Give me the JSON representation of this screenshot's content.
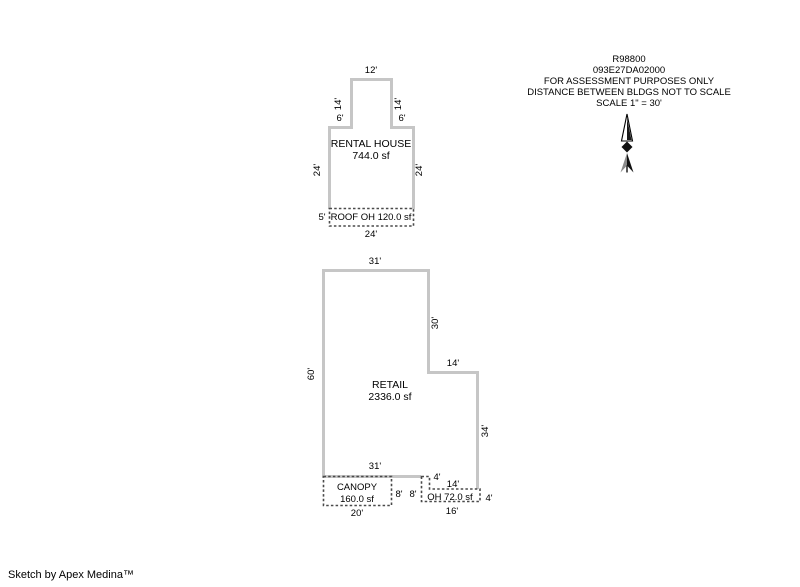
{
  "colors": {
    "background": "#ffffff",
    "building_outline": "#c6c6c6",
    "overhang_dashed": "#4a4a4a",
    "text": "#000000"
  },
  "title_block": {
    "lines": [
      "R98800",
      "093E27DA02000",
      "FOR ASSESSMENT PURPOSES ONLY",
      "DISTANCE BETWEEN BLDGS NOT TO SCALE",
      "SCALE 1\" = 30'"
    ]
  },
  "north_arrow": {
    "icon": "north-arrow"
  },
  "rental_house": {
    "name": "RENTAL HOUSE",
    "area": "744.0 sf",
    "dims": {
      "top_width": "12'",
      "tower_left": "14'",
      "tower_right": "14'",
      "shoulder_left": "6'",
      "shoulder_right": "6'",
      "side_left": "24'",
      "side_right": "24'",
      "roof_oh_height": "5'",
      "bottom_width": "24'"
    },
    "roof_oh": {
      "label": "ROOF OH 120.0 sf"
    }
  },
  "retail": {
    "name": "RETAIL",
    "area": "2336.0 sf",
    "dims": {
      "top_width": "31'",
      "left_side": "60'",
      "right_upper": "30'",
      "ext_top": "14'",
      "right_lower": "34'",
      "bottom_width": "31'",
      "step": "4'",
      "ext_bottom": "14'"
    },
    "canopy": {
      "name": "CANOPY",
      "area": "160.0 sf",
      "dims": {
        "right": "8'",
        "bottom": "20'"
      }
    },
    "oh": {
      "label": "OH 72.0 sf",
      "dims": {
        "left": "8'",
        "right": "4'",
        "bottom": "16'"
      }
    }
  },
  "footer": {
    "credit": "Sketch by Apex Medina™"
  }
}
